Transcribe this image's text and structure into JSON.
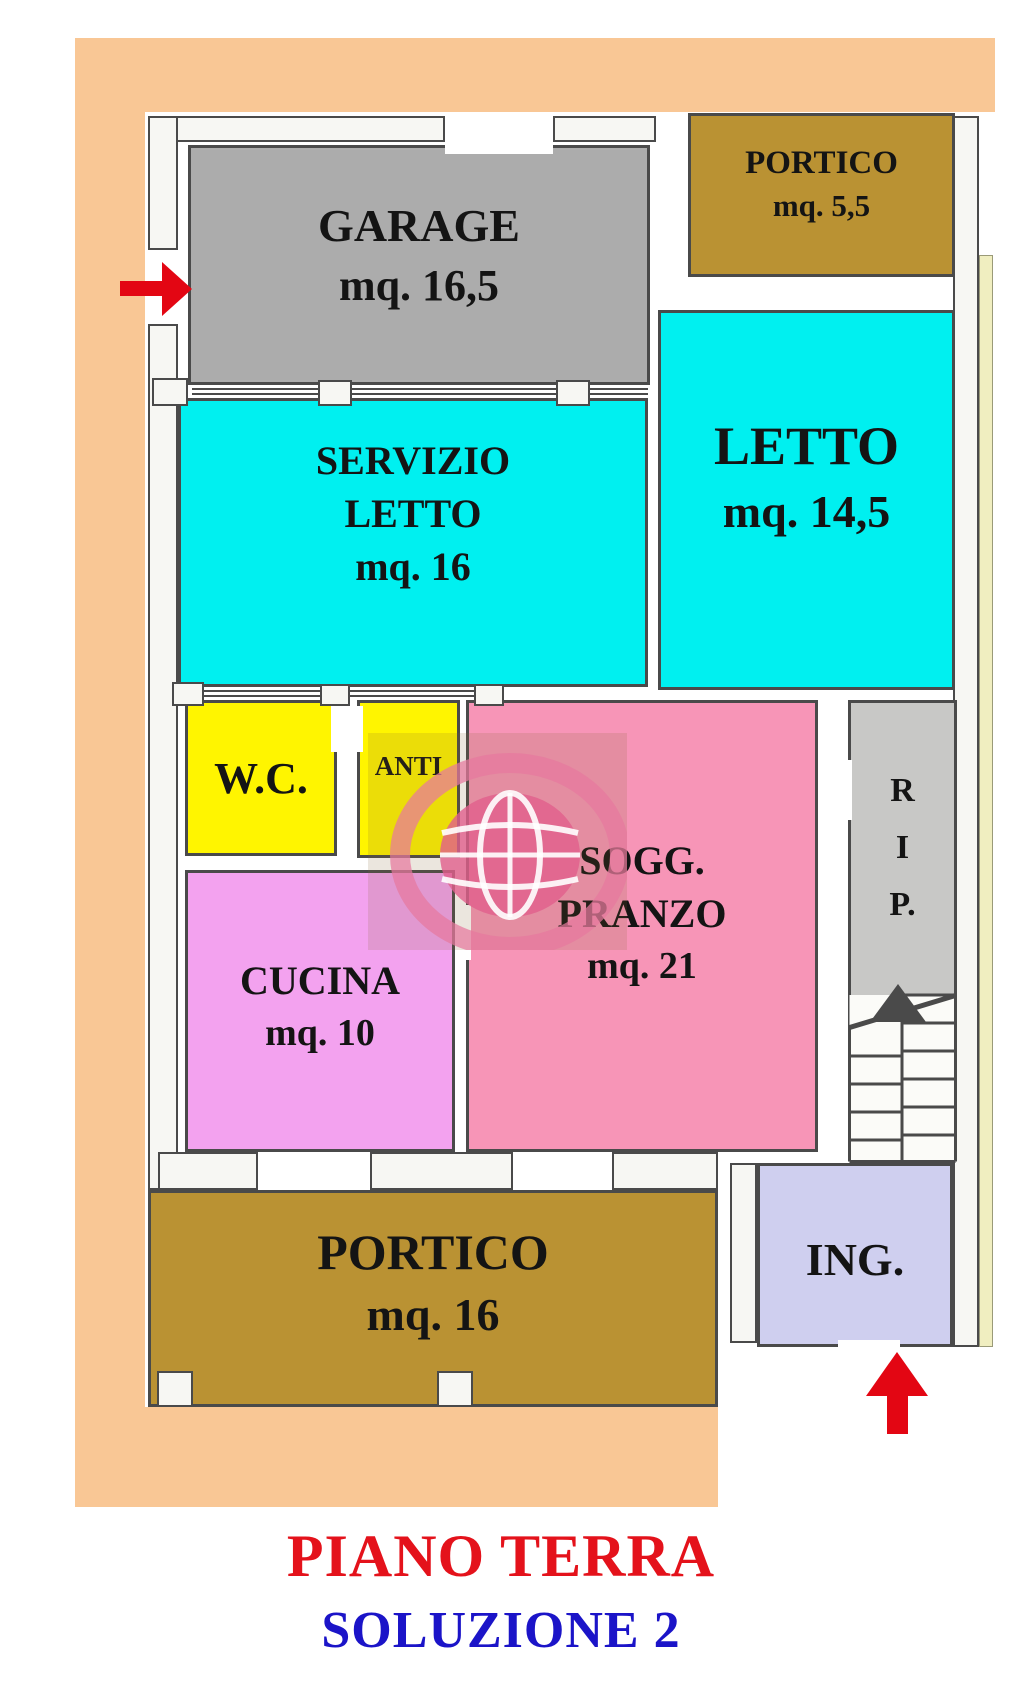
{
  "title": {
    "text": "PIANO TERRA",
    "color": "#E4121B"
  },
  "subtitle": {
    "text": "SOLUZIONE 2",
    "color": "#1B14C8"
  },
  "rooms": {
    "garage": {
      "name": "GARAGE",
      "area": "mq. 16,5",
      "color": "#ACACAC"
    },
    "portico_top": {
      "name": "PORTICO",
      "area": "mq. 5,5",
      "color": "#BA9233"
    },
    "servizio_letto": {
      "name": "SERVIZIO LETTO",
      "area": "mq. 16",
      "color": "#00F0F0"
    },
    "letto": {
      "name": "LETTO",
      "area": "mq. 14,5",
      "color": "#00F0F0"
    },
    "wc": {
      "name": "W.C.",
      "color": "#FFF500"
    },
    "anti": {
      "name": "ANTI",
      "color": "#FFF500"
    },
    "sogg_pranzo": {
      "name": "SOGG. PRANZO",
      "area": "mq. 21",
      "color": "#F795B7"
    },
    "rip": {
      "name": "R I P.",
      "color": "#C8C8C6"
    },
    "cucina": {
      "name": "CUCINA",
      "area": "mq. 10",
      "color": "#F3A2EF"
    },
    "portico_bottom": {
      "name": "PORTICO",
      "area": "mq. 16",
      "color": "#BA9233"
    },
    "ing": {
      "name": "ING.",
      "color": "#CFCFEF"
    }
  },
  "markers": {
    "garage_entrance_arrow": "red-arrow-right",
    "main_entrance_arrow": "red-arrow-up",
    "stairs_direction_arrow": "dark-arrow-up",
    "arrow_color": "#E30613"
  },
  "palette": {
    "mat_background": "#F9C795",
    "plan_background": "#FFFFFF",
    "wall_fill": "#F7F7F3",
    "wall_outline": "#4A4A4A",
    "neighbor_strip": "#F0EEC0",
    "label_text": "#141414",
    "watermark_pink": "#E27A9E"
  }
}
